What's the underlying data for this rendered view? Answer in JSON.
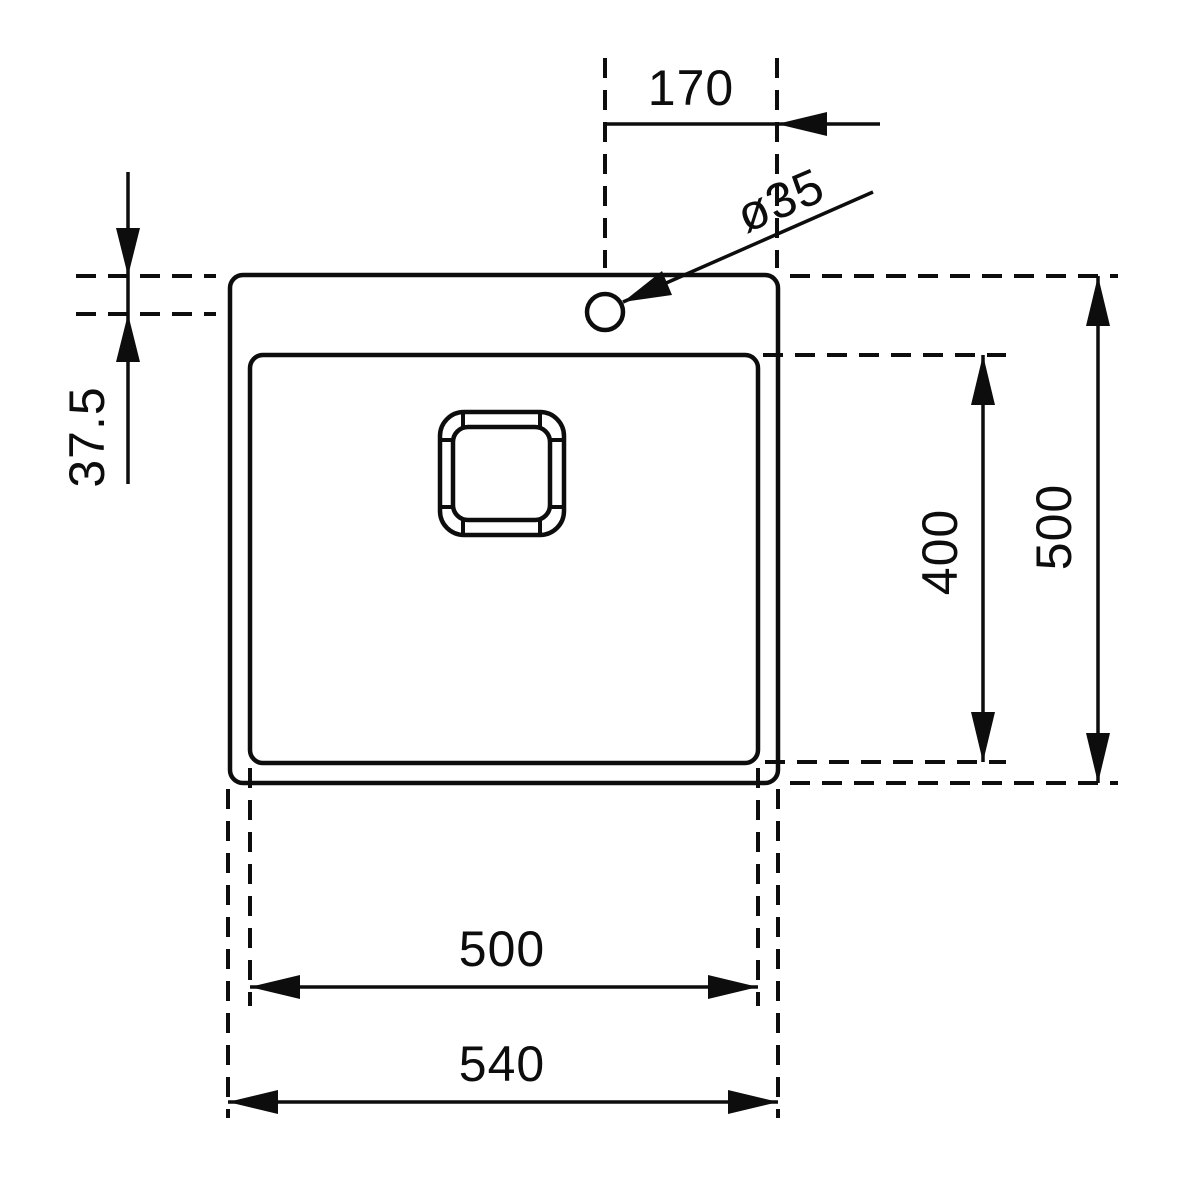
{
  "drawing": {
    "subject": "kitchen-sink-top-view-dimensional-drawing",
    "units": "mm",
    "stroke_color": "#0d0d0d",
    "background_color": "#ffffff",
    "dimensions": {
      "faucet_offset_from_right": {
        "value": 170,
        "label": "170"
      },
      "faucet_hole_diameter": {
        "value": 35,
        "label": "ø35"
      },
      "faucet_offset_from_top": {
        "value": 37.5,
        "label": "37.5"
      },
      "bowl_length": {
        "value": 400,
        "label": "400"
      },
      "overall_length": {
        "value": 500,
        "label": "500"
      },
      "bowl_width": {
        "value": 500,
        "label": "500"
      },
      "overall_width": {
        "value": 540,
        "label": "540"
      }
    }
  }
}
